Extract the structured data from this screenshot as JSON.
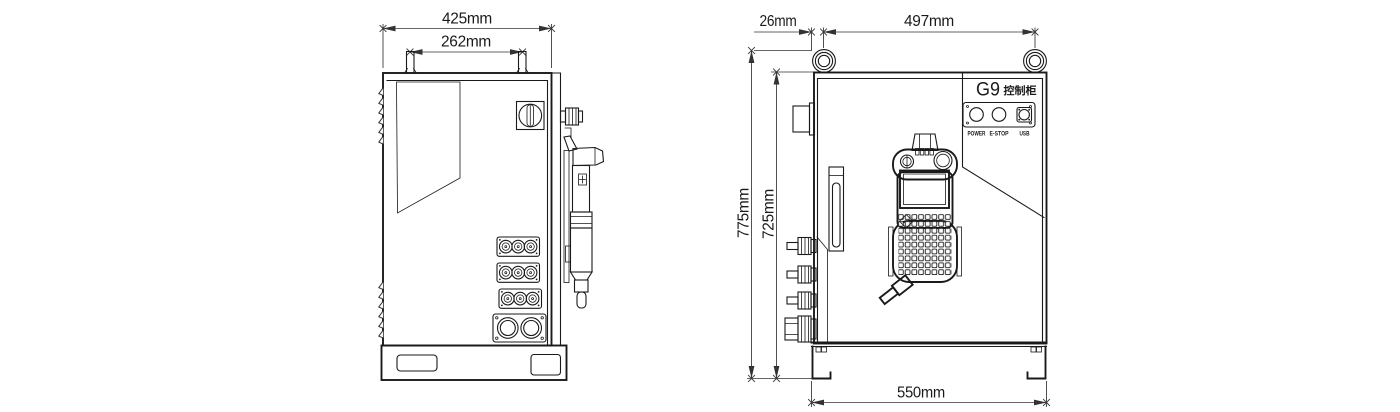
{
  "side_view": {
    "dims": {
      "overall_width": "425mm",
      "lug_spacing": "262mm"
    }
  },
  "front_view": {
    "dims": {
      "eyebolt_offset": "26mm",
      "eyebolt_spacing": "497mm",
      "overall_height": "775mm",
      "body_height": "725mm",
      "base_width": "550mm"
    },
    "panel": {
      "model": "G9",
      "model_type": "控制柜",
      "port_labels": [
        "POWER",
        "E-STOP",
        "USB"
      ]
    }
  },
  "colors": {
    "line": "#1a1a1a",
    "dimension": "#333333",
    "background": "#ffffff"
  }
}
